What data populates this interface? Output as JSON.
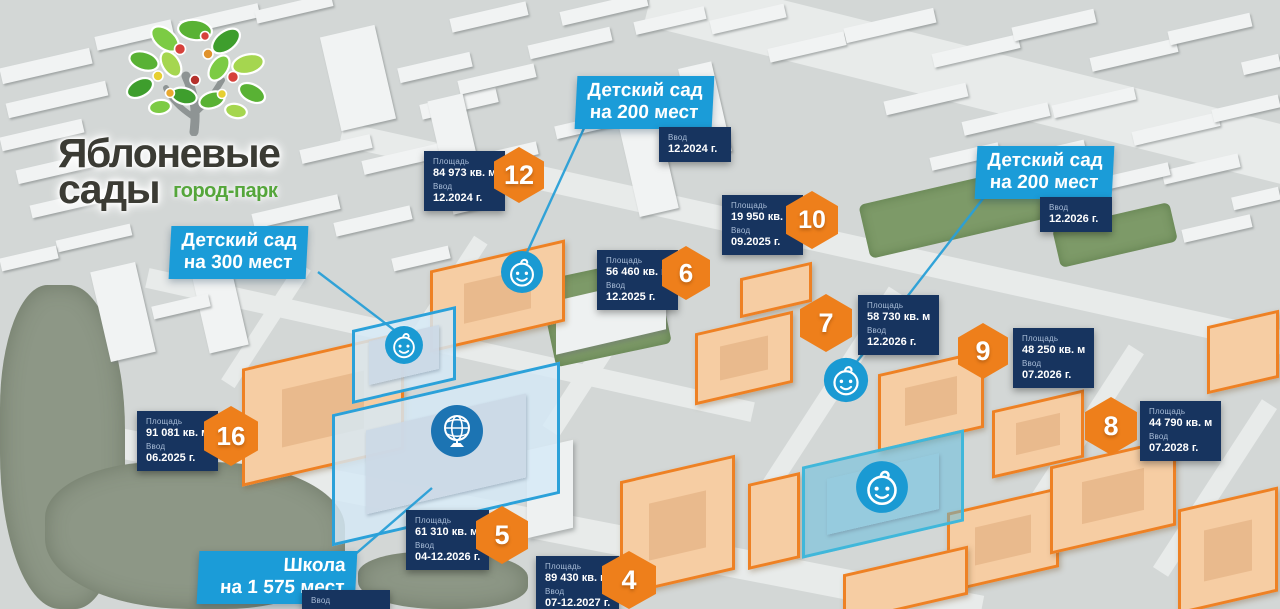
{
  "logo": {
    "title_line1": "Яблоневые",
    "title_line2": "сады",
    "tagline": "город-парк"
  },
  "common": {
    "area_label": "Площадь",
    "commissioning_label": "Ввод"
  },
  "facilities": {
    "kindergarten_300": {
      "line1": "Детский сад",
      "line2": "на 300 мест"
    },
    "kindergarten_200_center": {
      "line1": "Детский сад",
      "line2": "на 200 мест",
      "commissioning": "12.2024 г."
    },
    "kindergarten_200_east": {
      "line1": "Детский сад",
      "line2": "на 200 мест",
      "commissioning": "12.2026 г."
    },
    "school": {
      "line1": "Школа",
      "line2": "на 1 575 мест"
    }
  },
  "plots": [
    {
      "number": "12",
      "area": "84 973 кв. м",
      "commissioning": "12.2024 г."
    },
    {
      "number": "6",
      "area": "56 460 кв. м",
      "commissioning": "12.2025 г."
    },
    {
      "number": "10",
      "area": "19 950 кв. м",
      "commissioning": "09.2025 г."
    },
    {
      "number": "7",
      "area": "58 730 кв. м",
      "commissioning": "12.2026 г."
    },
    {
      "number": "9",
      "area": "48 250 кв. м",
      "commissioning": "07.2026 г."
    },
    {
      "number": "8",
      "area": "44 790 кв. м",
      "commissioning": "07.2028 г."
    },
    {
      "number": "16",
      "area": "91 081 кв. м",
      "commissioning": "06.2025 г."
    },
    {
      "number": "5",
      "area": "61 310 кв. м",
      "commissioning": "04-12.2026 г."
    },
    {
      "number": "4",
      "area": "89 430 кв. м",
      "commissioning": "07-12.2027 г."
    }
  ],
  "icons": {
    "kindergarten_icon": "baby-face",
    "school_icon": "globe"
  },
  "colors": {
    "accent_orange": "#ee7f1b",
    "label_blue": "#1b9cd8",
    "card_navy": "#17345f",
    "zone_outline_blue": "#2ba1d9"
  }
}
